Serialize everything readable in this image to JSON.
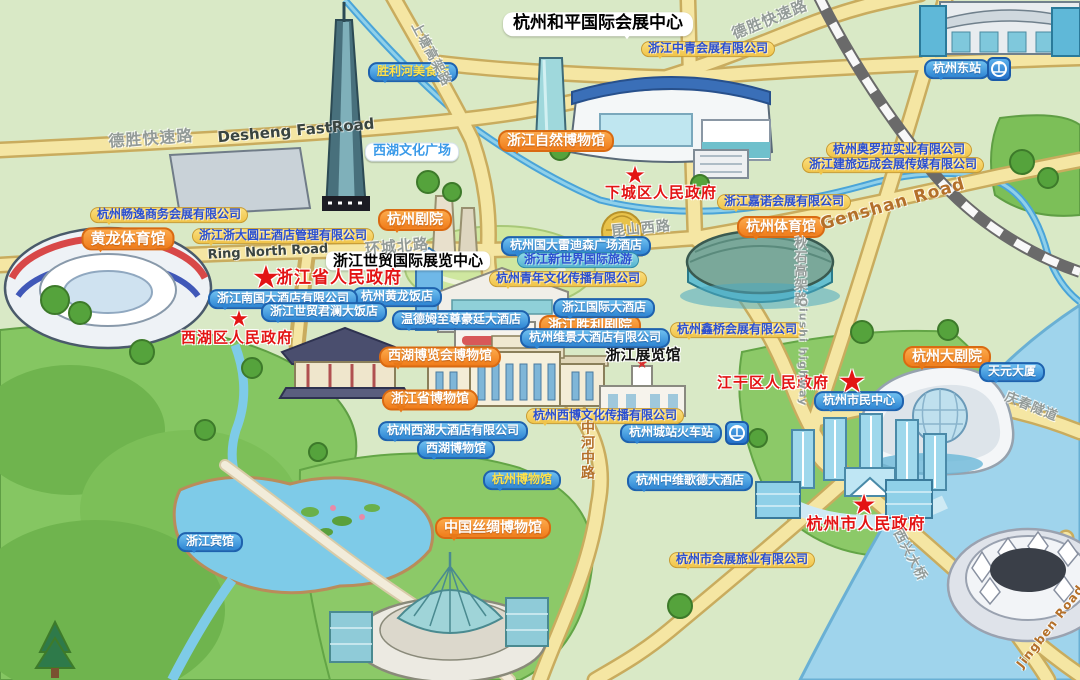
{
  "map": {
    "region": "杭州会展场馆分布手绘地图",
    "colors": {
      "land": "#d9e9c6",
      "park_green": "#8cc968",
      "water_blue": "#9fd4ec",
      "road_yellow": "#f5e6a3",
      "label_orange": "#f28020",
      "label_blue": "#2f86d4",
      "label_yellow": "#f0c44a",
      "gov_red": "#e31414",
      "rail_blue": "#2470c8"
    },
    "labels": [
      {
        "id": "peace-expo-center-title",
        "text": "杭州和平国际会展中心",
        "kind": "white-big",
        "x": 598,
        "y": 24
      },
      {
        "id": "world-trade-expo-center-title",
        "text": "浙江世贸国际展览中心",
        "kind": "white-mid",
        "x": 408,
        "y": 261
      },
      {
        "id": "zhejiang-exhibition-hall-label",
        "text": "浙江展览馆",
        "kind": "black-outline",
        "x": 643,
        "y": 355
      },
      {
        "id": "nature-museum-label",
        "text": "浙江自然博物馆",
        "kind": "orange",
        "x": 556,
        "y": 141
      },
      {
        "id": "hangzhou-theatre-label",
        "text": "杭州剧院",
        "kind": "orange",
        "x": 415,
        "y": 220
      },
      {
        "id": "yellow-dragon-stadium-label",
        "text": "黄龙体育馆",
        "kind": "orange",
        "x": 128,
        "y": 239,
        "size": 15
      },
      {
        "id": "hangzhou-gymnasium-label",
        "text": "杭州体育馆",
        "kind": "orange",
        "x": 781,
        "y": 227
      },
      {
        "id": "grand-theatre-label",
        "text": "杭州大剧院",
        "kind": "orange",
        "x": 947,
        "y": 357
      },
      {
        "id": "west-lake-expo-museum-label",
        "text": "西湖博览会博物馆",
        "kind": "orange",
        "x": 440,
        "y": 357,
        "size": 13
      },
      {
        "id": "provincial-museum-label",
        "text": "浙江省博物馆",
        "kind": "orange",
        "x": 430,
        "y": 400,
        "size": 13
      },
      {
        "id": "silk-museum-label",
        "text": "中国丝绸博物馆",
        "kind": "orange",
        "x": 493,
        "y": 528
      },
      {
        "id": "victory-theatre-label",
        "text": "浙江胜利剧院",
        "kind": "orange",
        "x": 590,
        "y": 326
      },
      {
        "id": "east-station-label",
        "text": "杭州东站",
        "kind": "blue",
        "x": 957,
        "y": 69
      },
      {
        "id": "east-station-rail-icon",
        "text": "",
        "kind": "rail-icon",
        "x": 999,
        "y": 69
      },
      {
        "id": "yellow-dragon-hotel-label",
        "text": "杭州黄龙饭店",
        "kind": "blue",
        "x": 397,
        "y": 297
      },
      {
        "id": "southland-hotel-label",
        "text": "浙江南国大酒店有限公司",
        "kind": "blue",
        "x": 283,
        "y": 299
      },
      {
        "id": "junlan-hotel-label",
        "text": "浙江世贸君澜大饭店",
        "kind": "blue",
        "x": 324,
        "y": 312
      },
      {
        "id": "wyndham-hotel-label",
        "text": "温德姆至尊豪廷大酒店",
        "kind": "blue",
        "x": 461,
        "y": 320
      },
      {
        "id": "radisson-hotel-label",
        "text": "杭州国大雷迪森广场酒店",
        "kind": "blue",
        "x": 576,
        "y": 246
      },
      {
        "id": "international-hotel-label",
        "text": "浙江国际大酒店",
        "kind": "blue",
        "x": 604,
        "y": 308
      },
      {
        "id": "weijing-hotel-label",
        "text": "杭州维景大酒店有限公司",
        "kind": "blue",
        "x": 595,
        "y": 338
      },
      {
        "id": "tianyuan-tower-label",
        "text": "天元大厦",
        "kind": "blue",
        "x": 1012,
        "y": 372
      },
      {
        "id": "citizen-center-label",
        "text": "杭州市民中心",
        "kind": "blue",
        "x": 859,
        "y": 401
      },
      {
        "id": "city-station-label",
        "text": "杭州城站火车站",
        "kind": "blue",
        "x": 671,
        "y": 433
      },
      {
        "id": "city-station-rail-icon",
        "text": "",
        "kind": "rail-icon",
        "x": 737,
        "y": 433
      },
      {
        "id": "goethe-hotel-label",
        "text": "杭州中维歌德大酒店",
        "kind": "blue",
        "x": 690,
        "y": 481
      },
      {
        "id": "westlake-hotel-label",
        "text": "杭州西湖大酒店有限公司",
        "kind": "blue",
        "x": 453,
        "y": 431
      },
      {
        "id": "westlake-museum-label",
        "text": "西湖博物馆",
        "kind": "blue",
        "x": 456,
        "y": 449
      },
      {
        "id": "hangzhou-museum-label",
        "text": "杭州博物馆",
        "kind": "blue-yellow",
        "x": 522,
        "y": 480
      },
      {
        "id": "zhejiang-hotel-label",
        "text": "浙江宾馆",
        "kind": "blue",
        "x": 210,
        "y": 542
      },
      {
        "id": "shengli-food-street-label",
        "text": "胜利河美食街",
        "kind": "blue-yellow",
        "x": 413,
        "y": 72
      },
      {
        "id": "culture-square-label",
        "text": "西湖文化广场",
        "kind": "whiteblue",
        "x": 412,
        "y": 152
      },
      {
        "id": "zhongqing-expo-co-label",
        "text": "浙江中青会展有限公司",
        "kind": "yellow",
        "x": 708,
        "y": 49
      },
      {
        "id": "aurora-co-label",
        "text": "杭州奥罗拉实业有限公司",
        "kind": "yellow",
        "x": 899,
        "y": 150
      },
      {
        "id": "jianlv-media-co-label",
        "text": "浙江建旅远成会展传媒有限公司",
        "kind": "yellow",
        "x": 893,
        "y": 165
      },
      {
        "id": "jianuo-expo-co-label",
        "text": "浙江嘉诺会展有限公司",
        "kind": "yellow",
        "x": 784,
        "y": 202
      },
      {
        "id": "changyi-expo-co-label",
        "text": "杭州畅逸商务会展有限公司",
        "kind": "yellow",
        "x": 169,
        "y": 215
      },
      {
        "id": "yuanzheng-hotel-co-label",
        "text": "浙江浙大圆正酒店管理有限公司",
        "kind": "yellow",
        "x": 283,
        "y": 236
      },
      {
        "id": "youth-culture-co-label",
        "text": "杭州青年文化传播有限公司",
        "kind": "yellow",
        "x": 568,
        "y": 279
      },
      {
        "id": "xinqiao-expo-co-label",
        "text": "杭州鑫桥会展有限公司",
        "kind": "yellow",
        "x": 737,
        "y": 330
      },
      {
        "id": "xibo-culture-co-label",
        "text": "杭州西博文化传播有限公司",
        "kind": "yellow",
        "x": 605,
        "y": 416
      },
      {
        "id": "exhibition-travel-co-label",
        "text": "杭州市会展旅业有限公司",
        "kind": "yellow",
        "x": 742,
        "y": 560
      },
      {
        "id": "new-world-travel-label",
        "text": "浙江新世界国际旅游",
        "kind": "teal",
        "x": 578,
        "y": 260
      },
      {
        "id": "xiacheng-gov-label",
        "text": "下城区人民政府",
        "kind": "gov",
        "x": 661,
        "y": 193,
        "size": 15
      },
      {
        "id": "xiacheng-gov-star",
        "text": "★",
        "kind": "star",
        "x": 635,
        "y": 175,
        "size": 24
      },
      {
        "id": "province-gov-label",
        "text": "浙江省人民政府",
        "kind": "gov",
        "x": 339,
        "y": 279,
        "size": 17
      },
      {
        "id": "province-gov-star",
        "text": "★",
        "kind": "star",
        "x": 266,
        "y": 277,
        "size": 32
      },
      {
        "id": "xihu-gov-label",
        "text": "西湖区人民政府",
        "kind": "gov",
        "x": 237,
        "y": 338,
        "size": 15
      },
      {
        "id": "xihu-gov-star",
        "text": "★",
        "kind": "star",
        "x": 239,
        "y": 320,
        "size": 22
      },
      {
        "id": "jianggan-gov-label",
        "text": "江干区人民政府",
        "kind": "gov",
        "x": 773,
        "y": 383,
        "size": 15
      },
      {
        "id": "jianggan-gov-star",
        "text": "★",
        "kind": "star",
        "x": 852,
        "y": 381,
        "size": 32
      },
      {
        "id": "city-gov-label",
        "text": "杭州市人民政府",
        "kind": "gov",
        "x": 866,
        "y": 524,
        "size": 16
      },
      {
        "id": "city-gov-star",
        "text": "★",
        "kind": "star",
        "x": 864,
        "y": 505,
        "size": 28
      },
      {
        "id": "desheng-road-left",
        "text": "德胜快速路",
        "kind": "road",
        "x": 151,
        "y": 139,
        "rot": -4,
        "size": 16
      },
      {
        "id": "desheng-road-en",
        "text": "Desheng FastRoad",
        "kind": "road-dark",
        "x": 296,
        "y": 131,
        "rot": -5,
        "size": 15
      },
      {
        "id": "desheng-road-right",
        "text": "德胜快速路",
        "kind": "road",
        "x": 770,
        "y": 20,
        "rot": -22,
        "size": 15
      },
      {
        "id": "shangtang-road",
        "text": "上塘高架路",
        "kind": "road",
        "x": 430,
        "y": 55,
        "rot": 62,
        "size": 13
      },
      {
        "id": "ring-north-road-cn",
        "text": "环城北路",
        "kind": "road",
        "x": 397,
        "y": 247,
        "rot": -5,
        "size": 15
      },
      {
        "id": "ring-north-road-en",
        "text": "Ring North Road",
        "kind": "road-dark",
        "x": 268,
        "y": 253,
        "rot": -3,
        "size": 13
      },
      {
        "id": "kunshan-road",
        "text": "昆山西路",
        "kind": "road",
        "x": 641,
        "y": 229,
        "rot": -6,
        "size": 14
      },
      {
        "id": "genshan-road",
        "text": "Genshan Road",
        "kind": "road-orange",
        "x": 893,
        "y": 205,
        "rot": -16,
        "size": 17
      },
      {
        "id": "qiushi-road-cn",
        "text": "秋石高架路",
        "kind": "road",
        "x": 798,
        "y": 271,
        "vert": true,
        "size": 13
      },
      {
        "id": "qiushi-road-en",
        "text": "Qiushi highway",
        "kind": "road",
        "x": 802,
        "y": 352,
        "vert": true,
        "size": 11
      },
      {
        "id": "zhonghe-road",
        "text": "中河中路",
        "kind": "road-orange",
        "x": 587,
        "y": 450,
        "vert": true,
        "size": 14
      },
      {
        "id": "qingchun-tunnel",
        "text": "庆春隧道",
        "kind": "road",
        "x": 1031,
        "y": 408,
        "rot": 22,
        "size": 13
      },
      {
        "id": "xixing-bridge",
        "text": "西兴大桥",
        "kind": "road",
        "x": 909,
        "y": 556,
        "rot": 62,
        "size": 13
      },
      {
        "id": "jingben-road",
        "text": "Jingben Road",
        "kind": "road-orange",
        "x": 1051,
        "y": 627,
        "rot": -52,
        "size": 12
      }
    ]
  }
}
